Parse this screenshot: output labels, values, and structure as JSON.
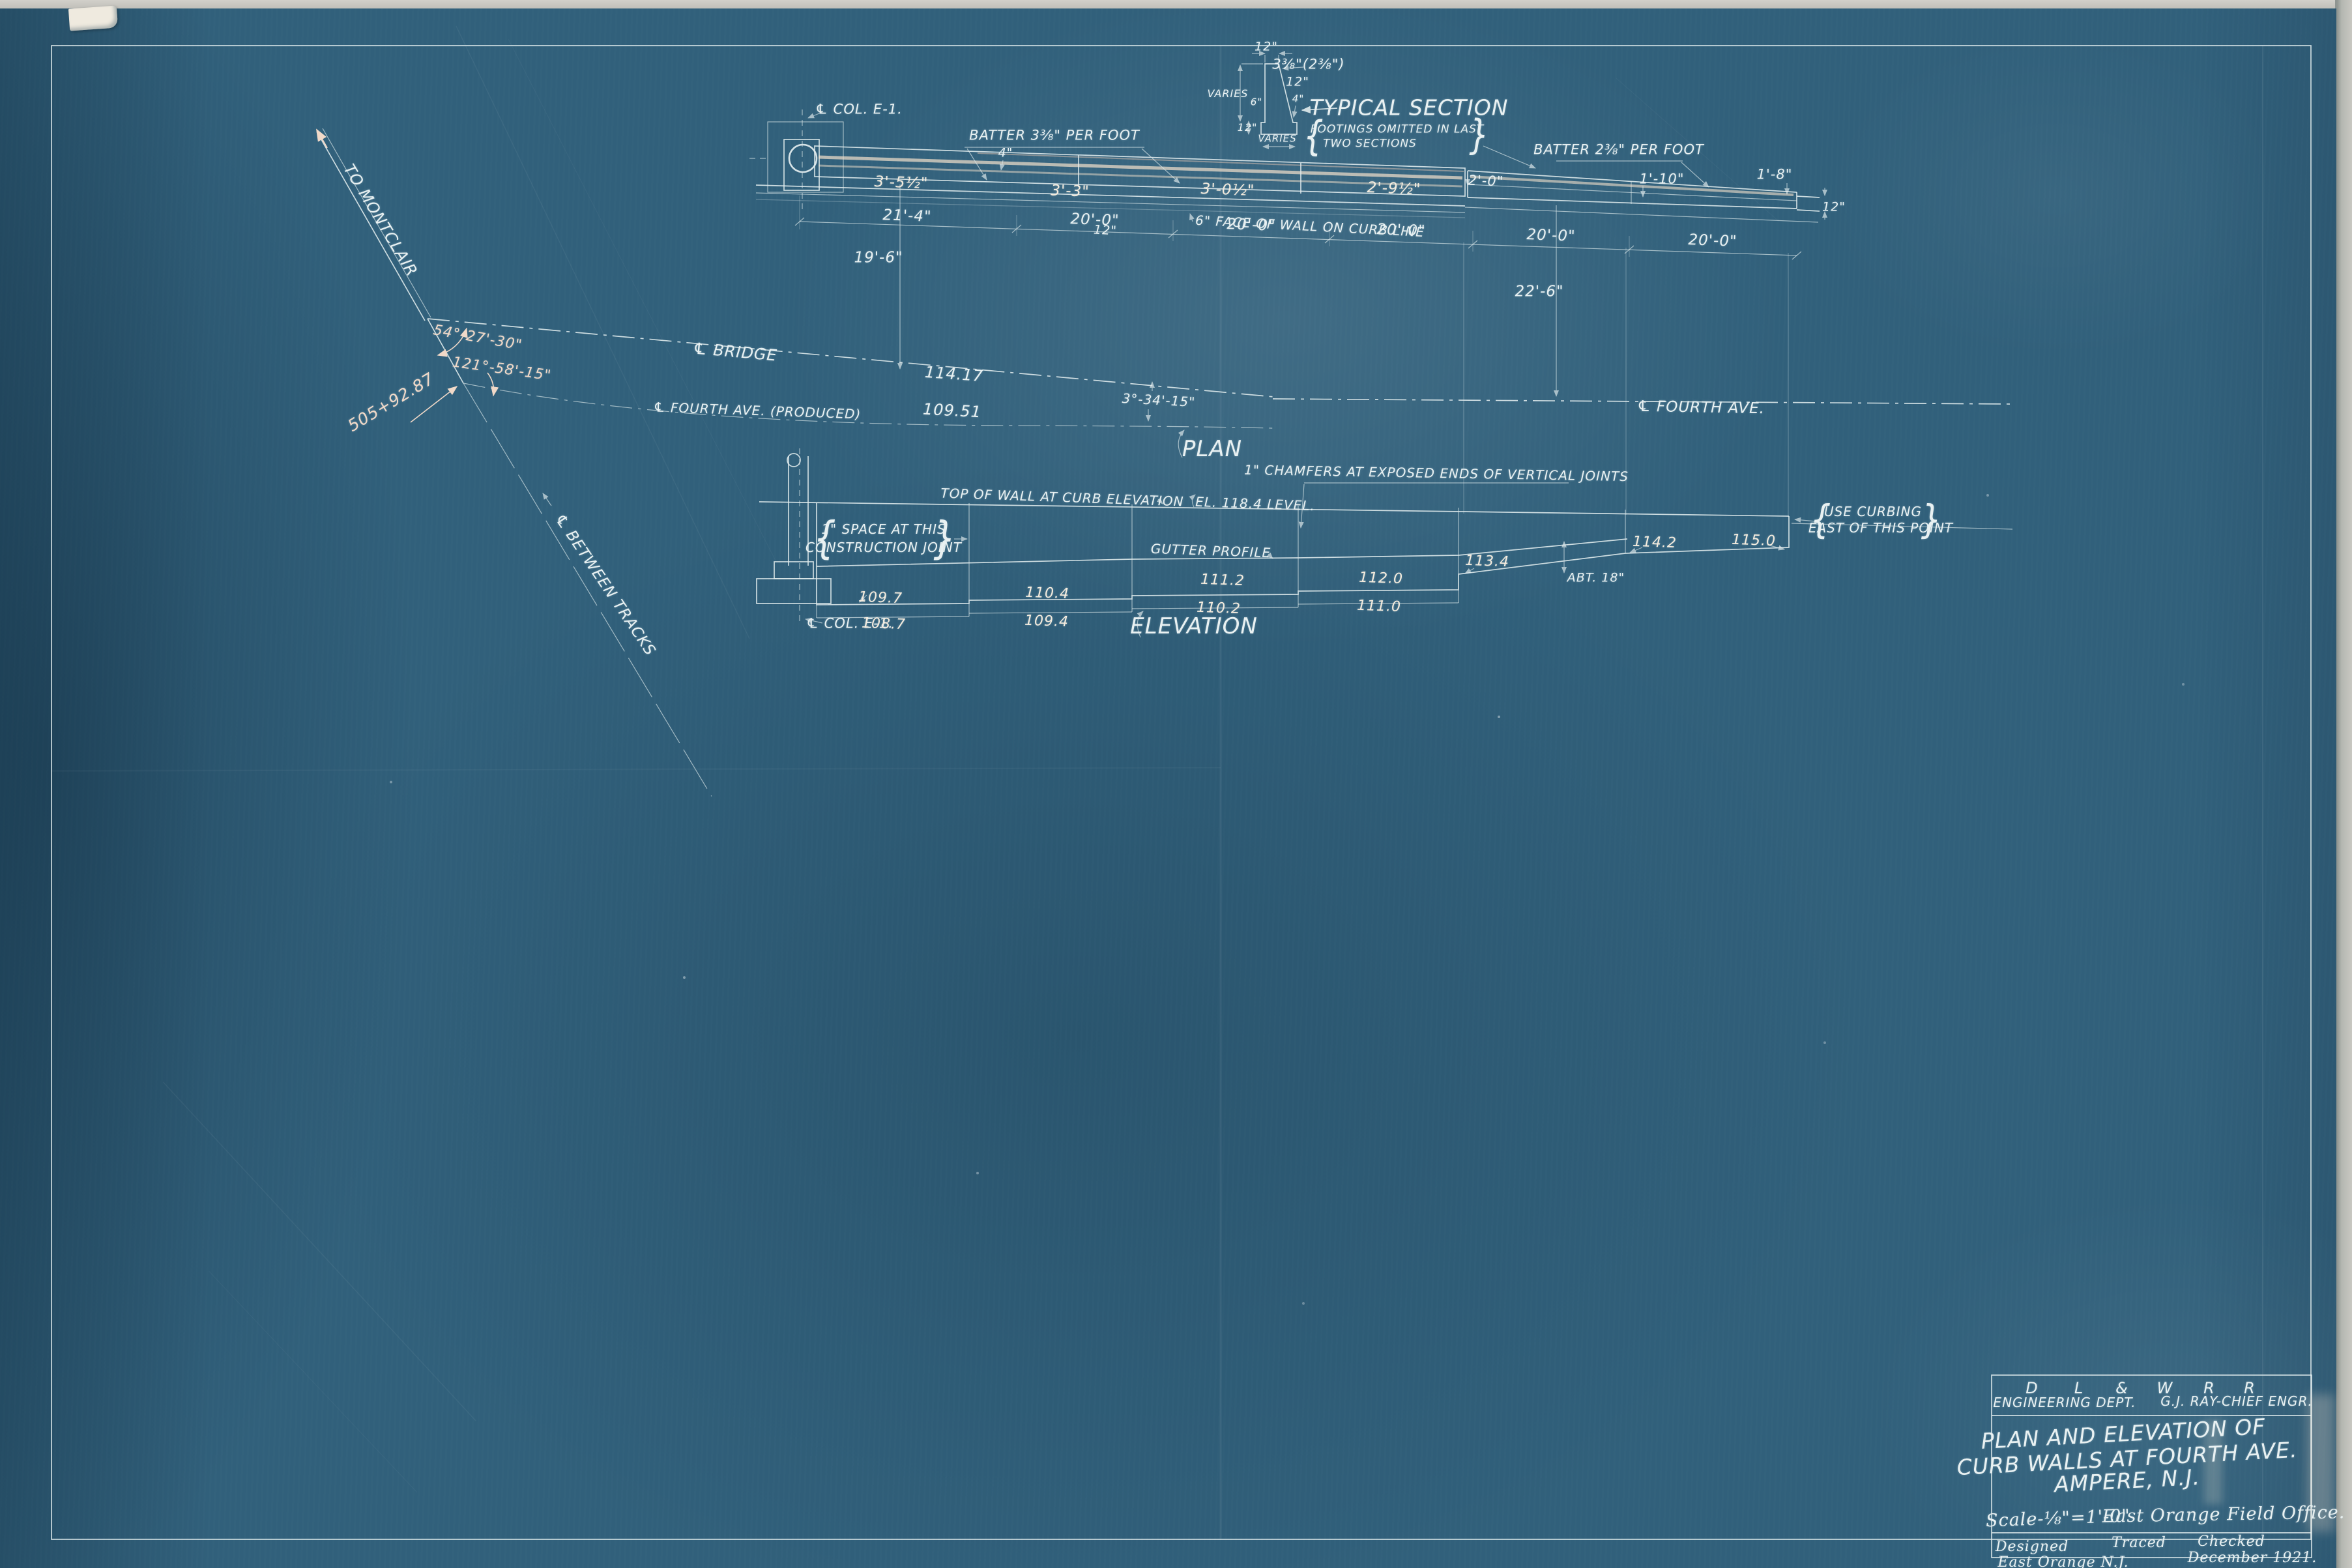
{
  "colors": {
    "paper_blue": "#31607b",
    "line_white": "#e9f1f2",
    "overexposed_cream": "#f4e1cc",
    "accent_pink": "#f1d9c8",
    "scan_gray": "#c9c8c2"
  },
  "glyphs": {
    "brace_open": "{",
    "brace_close": "}"
  },
  "typical_section": {
    "title": "TYPICAL SECTION",
    "note1": "FOOTINGS OMITTED IN LAST",
    "note2": "TWO SECTIONS",
    "dim_top": "12\"",
    "dim_batter": "3⅜\"(2⅜\")",
    "dim_12": "12\"",
    "varies_left": "VARIES",
    "dim_6": "6\"",
    "dim_4": "4\"",
    "dim_12b": "12\"",
    "varies_bottom": "VARIES"
  },
  "plan": {
    "label": "PLAN",
    "col_label": "℄ COL. E-1.",
    "batter_left": "BATTER 3⅜\" PER FOOT",
    "batter_right": "BATTER 2⅜\" PER FOOT",
    "dim_3_5": "3'-5½\"",
    "dim_4": "4\"",
    "dim_3_3": "3'-3\"",
    "dim_12a": "12\"",
    "dim_3_0": "3'-0½\"",
    "dim_2_9": "2'-9½\"",
    "dim_2_0": "2'-0\"",
    "dim_1_10": "1'-10\"",
    "dim_1_8": "1'-8\"",
    "dim_12b": "12\"",
    "face_note": "6\" FACE OF WALL ON CURB LINE",
    "span_21_4": "21'-4\"",
    "span_20": "20'-0\"",
    "dim_19_6": "19'-6\"",
    "dim_22_6": "22'-6\""
  },
  "centerlines": {
    "bridge": "℄ BRIDGE",
    "bridge_elev": "114.17",
    "fourth_produced": "℄ FOURTH AVE. (PRODUCED)",
    "fourth_elev": "109.51",
    "fourth": "℄ FOURTH AVE.",
    "angle_mid": "3°-34'-15\"",
    "angle_upper": "54°-27'-30\"",
    "angle_lower": "121°-58'-15\"",
    "station": "505+92.87",
    "to_montclair": "TO MONTCLAIR",
    "between_tracks": "℄ BETWEEN TRACKS"
  },
  "elevation": {
    "label": "ELEVATION",
    "top_note": "TOP OF WALL AT CURB ELEVATION",
    "level_note": "EL. 118.4 LEVEL.",
    "chamfer_note": "1\" CHAMFERS AT EXPOSED ENDS OF VERTICAL JOINTS",
    "space_note1": "1\" SPACE AT THIS",
    "space_note2": "CONSTRUCTION JOINT",
    "gutter_note": "GUTTER PROFILE",
    "abt_note": "ABT. 18\"",
    "curbing_note1": "USE CURBING",
    "curbing_note2": "EAST OF THIS POINT",
    "col_label": "℄ COL. E-1.",
    "elev_109_7": "109.7",
    "elev_108_7": "108.7",
    "elev_110_4": "110.4",
    "elev_109_4": "109.4",
    "elev_111_2": "111.2",
    "elev_110_2": "110.2",
    "elev_112_0": "112.0",
    "elev_111_0": "111.0",
    "elev_113_4": "113.4",
    "elev_114_2": "114.2",
    "elev_115_0": "115.0"
  },
  "title_block": {
    "railroad_letters": [
      "D",
      "L",
      "&",
      "W",
      "R",
      "R"
    ],
    "dept": "ENGINEERING DEPT.",
    "engineer": "G.J. RAY-CHIEF ENGR.",
    "title1": "PLAN AND ELEVATION OF",
    "title2": "CURB WALLS AT FOURTH AVE.",
    "title3": "AMPERE, N.J.",
    "scale": "Scale-⅛\"=1'-0\"",
    "office": "East Orange Field Office.",
    "designed": "Designed",
    "designed_place": "East Orange N.J.",
    "traced": "Traced",
    "checked": "Checked",
    "date": "December 1921."
  }
}
